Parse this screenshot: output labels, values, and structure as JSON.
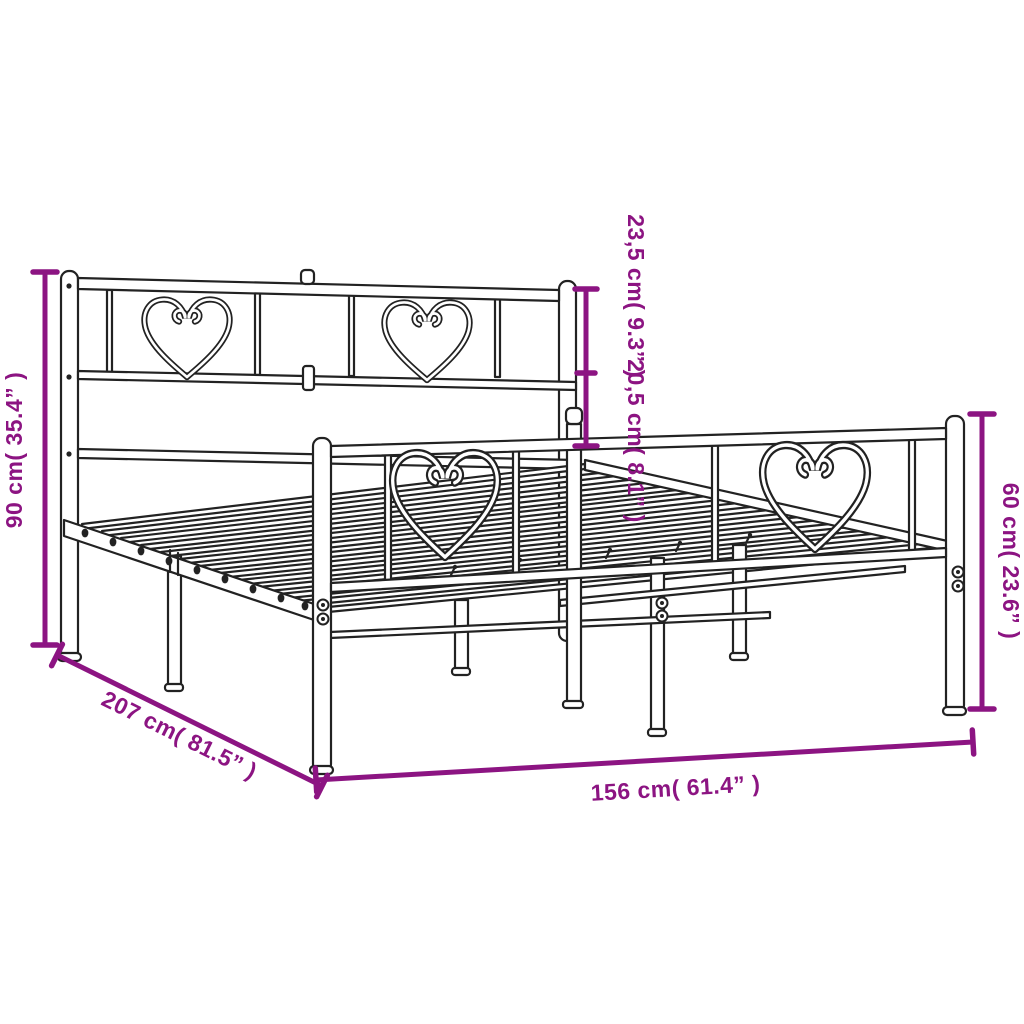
{
  "diagram": {
    "type": "product-dimension-diagram",
    "subject": "Metal bed frame with headboard and footboard, heart design",
    "style": {
      "accent_color": "#8C1482",
      "line_color": "#222222",
      "background_color": "#ffffff"
    },
    "dimensions": {
      "headboard_height": {
        "label": "90 cm( 35.4” )",
        "metric": "90 cm",
        "imperial": "35.4”"
      },
      "headboard_top_section": {
        "label": "23,5 cm( 9.3” )",
        "metric": "23,5 cm",
        "imperial": "9.3”"
      },
      "headboard_mid_section": {
        "label": "20,5 cm( 8.1” )",
        "metric": "20,5 cm",
        "imperial": "8.1”"
      },
      "footboard_height": {
        "label": "60 cm( 23.6” )",
        "metric": "60 cm",
        "imperial": "23.6”"
      },
      "frame_length": {
        "label": "207 cm( 81.5” )",
        "metric": "207 cm",
        "imperial": "81.5”"
      },
      "frame_width": {
        "label": "156 cm( 61.4” )",
        "metric": "156 cm",
        "imperial": "61.4”"
      }
    }
  }
}
